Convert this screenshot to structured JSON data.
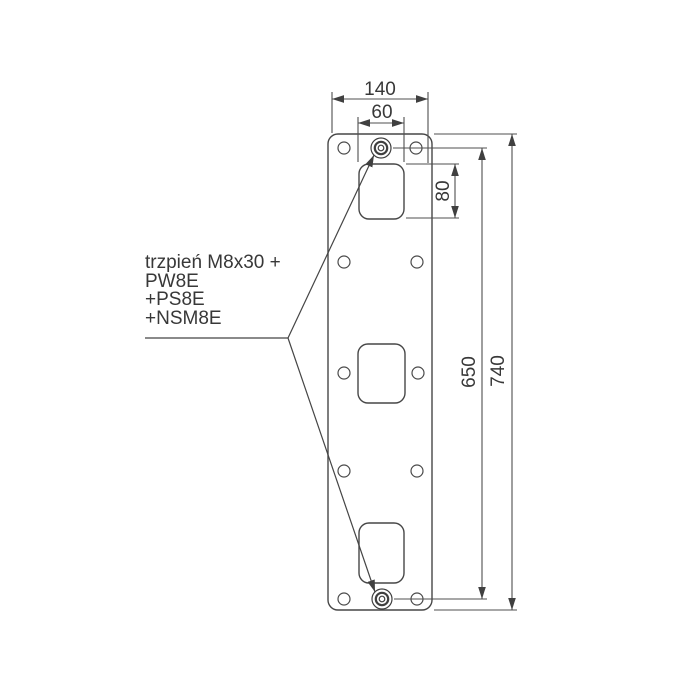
{
  "drawing": {
    "type": "technical-dimension-drawing",
    "label": {
      "lines": [
        "trzpień M8x30 +",
        "PW8E",
        "+PS8E",
        "+NSM8E"
      ]
    },
    "dimensions": {
      "plate_width_top": "140",
      "cutout_width": "60",
      "cutout_height": "80",
      "pin_to_pin": "650",
      "plate_height": "740"
    },
    "colors": {
      "background": "#ffffff",
      "geometry_line": "#474747",
      "dimension_line": "#4f4f4f",
      "text": "#383838"
    }
  }
}
